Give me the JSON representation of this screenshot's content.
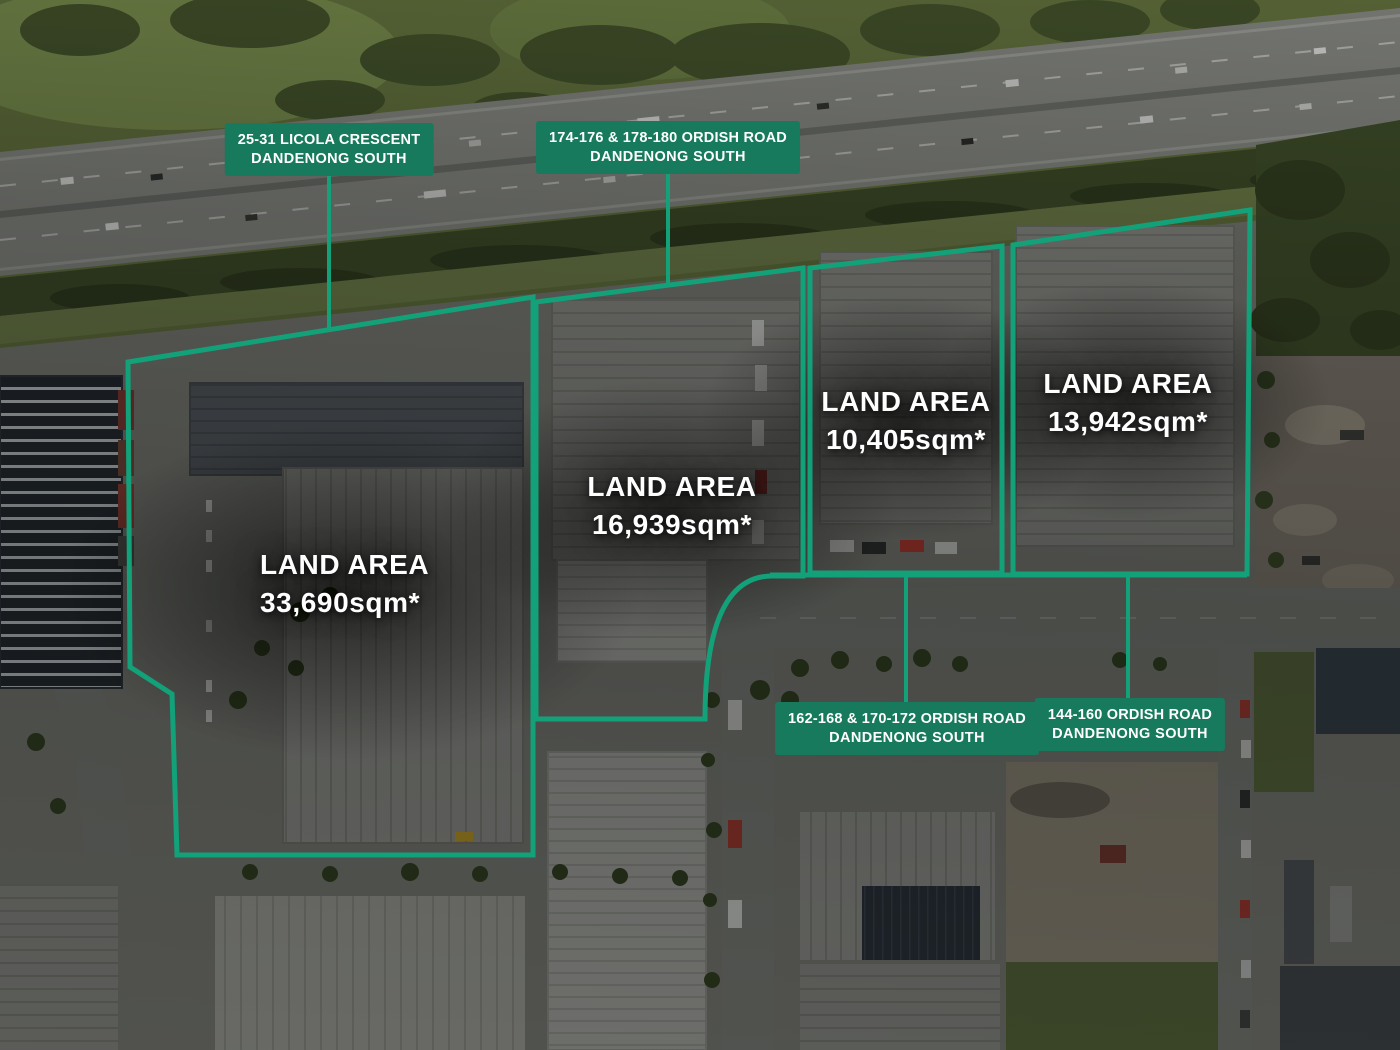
{
  "theme": {
    "line_green": "#12a178",
    "box_green": "#177a5c",
    "label_text": "#ffffff"
  },
  "address_labels": [
    {
      "line1": "25-31 LICOLA CRESCENT",
      "line2": "DANDENONG SOUTH"
    },
    {
      "line1": "174-176 & 178-180 ORDISH ROAD",
      "line2": "DANDENONG SOUTH"
    },
    {
      "line1": "162-168 & 170-172 ORDISH ROAD",
      "line2": "DANDENONG SOUTH"
    },
    {
      "line1": "144-160 ORDISH ROAD",
      "line2": "DANDENONG SOUTH"
    }
  ],
  "parcels": [
    {
      "label": "LAND AREA",
      "area": "33,690sqm*"
    },
    {
      "label": "LAND AREA",
      "area": "16,939sqm*"
    },
    {
      "label": "LAND AREA",
      "area": "10,405sqm*"
    },
    {
      "label": "LAND AREA",
      "area": "13,942sqm*"
    }
  ]
}
